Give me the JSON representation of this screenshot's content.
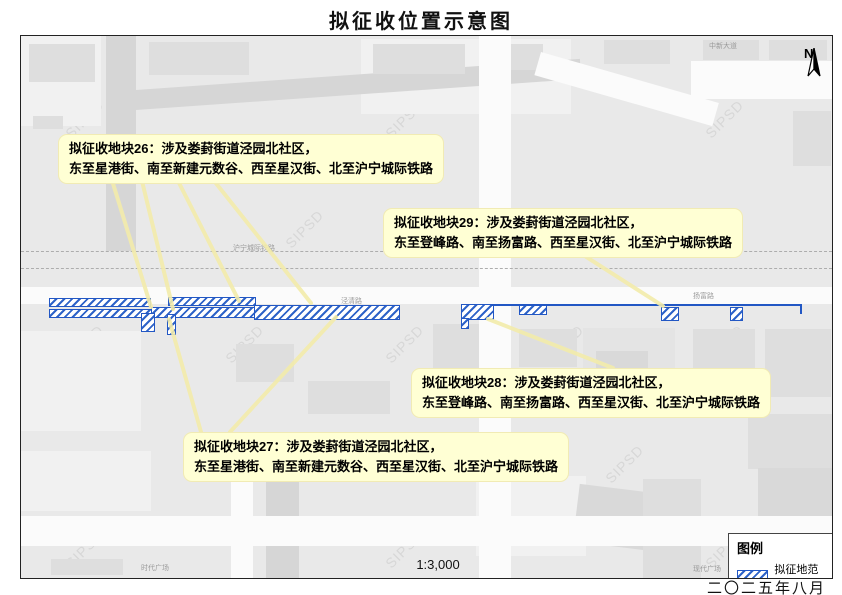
{
  "page": {
    "title": "拟征收位置示意图",
    "scale_label": "1:3,000",
    "date_label": "二〇二五年八月"
  },
  "north_arrow": {
    "label": "N"
  },
  "legend": {
    "title": "图例",
    "items": [
      {
        "label": "拟征地范围",
        "swatch": "blue-diagonal-hatch"
      }
    ]
  },
  "callouts": [
    {
      "id": "parcel-26",
      "line1": "拟征收地块26：涉及娄葑街道泾园北社区，",
      "line2": "东至星港街、南至新建元数谷、西至星汉街、北至沪宁城际铁路"
    },
    {
      "id": "parcel-29",
      "line1": "拟征收地块29：涉及娄葑街道泾园北社区，",
      "line2": "东至登峰路、南至扬富路、西至星汉街、北至沪宁城际铁路"
    },
    {
      "id": "parcel-28",
      "line1": "拟征收地块28：涉及娄葑街道泾园北社区，",
      "line2": "东至登峰路、南至扬富路、西至星汉街、北至沪宁城际铁路"
    },
    {
      "id": "parcel-27",
      "line1": "拟征收地块27：涉及娄葑街道泾园北社区，",
      "line2": "东至星港街、南至新建元数谷、西至星汉街、北至沪宁城际铁路"
    }
  ],
  "map_labels": {
    "railway": "沪宁城际铁路",
    "top_road": "中新大道",
    "left_road": "泾清路",
    "right_road": "扬富路",
    "plaza_left": "时代广场",
    "plaza_right": "现代广场"
  },
  "watermark": {
    "text": "SIPSD"
  },
  "colors": {
    "callout_bg": "#ffffd4",
    "parcel_border": "#2257c4",
    "leader_line": "#f3ecab",
    "map_bg": "#e9e9e9"
  }
}
